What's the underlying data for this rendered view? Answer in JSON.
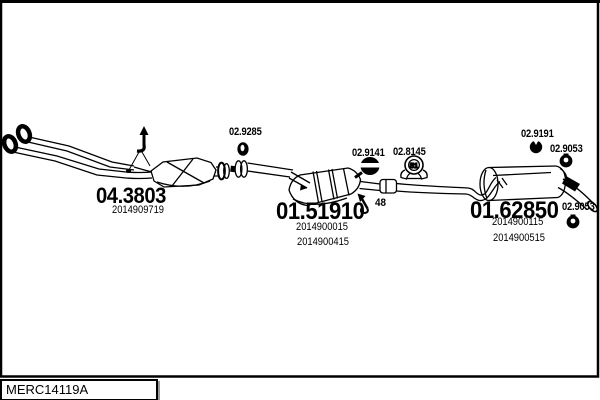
{
  "canvas": {
    "background_color": "#ffffff",
    "ink_color": "#000000",
    "shadow_color": "#9a9a9a"
  },
  "drawing_code": "MERC14119A",
  "parts": {
    "front_pipe_catalyst": {
      "number": "04.3803",
      "oe_refs": [
        "2014909719"
      ]
    },
    "centre_silencer": {
      "number": "01.51910",
      "footnote": "48",
      "oe_refs": [
        "2014900015",
        "2014900415"
      ]
    },
    "rear_silencer": {
      "number": "01.62850",
      "oe_refs": [
        "2014900115",
        "2014900515"
      ]
    }
  },
  "fittings": {
    "front_clamp": {
      "number": "02.9285"
    },
    "centre_clamp": {
      "number": "02.9141"
    },
    "bracket_clamp": {
      "number": "02.8145",
      "diameter": "51"
    },
    "rubber_mount": {
      "number": "02.9191"
    },
    "hanger_ring_top": {
      "number": "02.9053"
    },
    "hanger_ring_rear": {
      "number": "02.9053"
    }
  },
  "icons": {
    "footnote_arrow": "↖",
    "hanger_direction_arrow": "↑"
  }
}
